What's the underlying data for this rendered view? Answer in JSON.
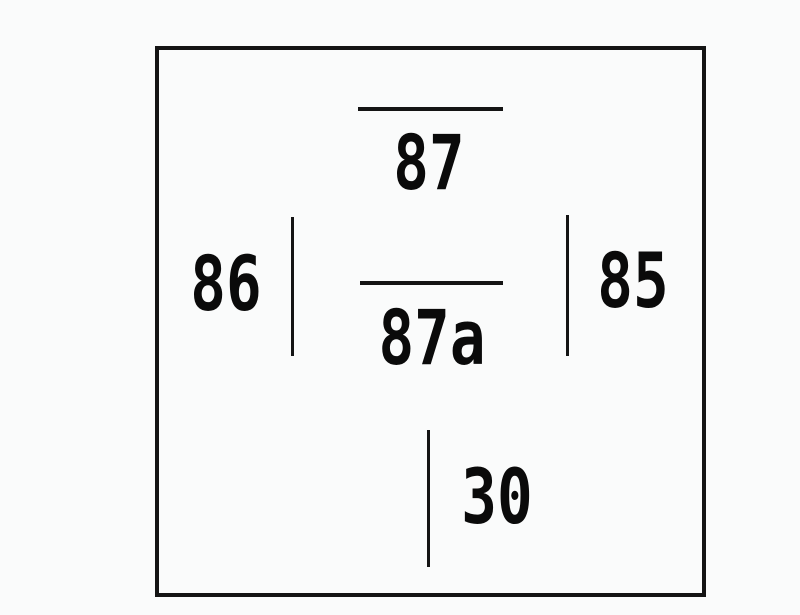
{
  "diagram": {
    "background_color": "#fafbfb",
    "line_color": "#141414",
    "text_color": "#0a0a0a"
  },
  "pins": [
    {
      "label": "87",
      "lead": "overline-above-label"
    },
    {
      "label": "87a",
      "lead": "overline-above-label"
    },
    {
      "label": "86",
      "lead": "vertical-line-right-of-label"
    },
    {
      "label": "85",
      "lead": "vertical-line-left-of-label"
    },
    {
      "label": "30",
      "lead": "vertical-line-left-of-label"
    }
  ]
}
